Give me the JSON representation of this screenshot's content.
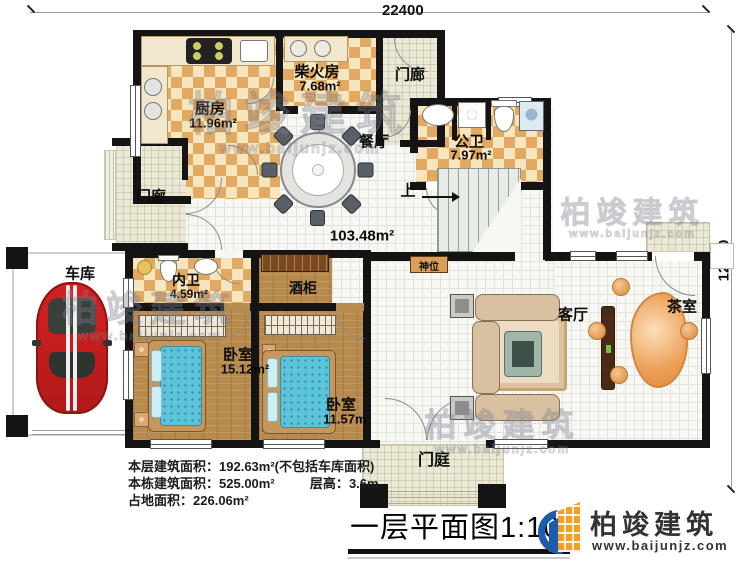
{
  "dimensions": {
    "top_width": "22400",
    "right_height": "12900"
  },
  "rooms": {
    "kitchen": {
      "name": "厨房",
      "area": "11.96m²"
    },
    "firewood_room": {
      "name": "柴火房",
      "area": "7.68m²"
    },
    "porch_top": {
      "name": "门廊"
    },
    "porch_left": {
      "name": "门廊"
    },
    "dining_room": {
      "name": "餐厅"
    },
    "public_bathroom": {
      "name": "公卫",
      "area": "7.97m²"
    },
    "hall": {
      "area": "103.48m²"
    },
    "stairs": {
      "up_label": "上"
    },
    "shrine": {
      "name": "神位"
    },
    "garage": {
      "name": "车库"
    },
    "private_bathroom": {
      "name": "内卫",
      "area": "4.59m²"
    },
    "wine_cabinet": {
      "name": "酒柜"
    },
    "bedroom_large": {
      "name": "卧室",
      "area": "15.12m²"
    },
    "bedroom_small": {
      "name": "卧室",
      "area": "11.57m²"
    },
    "living_room": {
      "name": "客厅"
    },
    "tea_room": {
      "name": "茶室"
    },
    "entrance_court": {
      "name": "门庭"
    }
  },
  "info": {
    "floor_area_label": "本层建筑面积：",
    "floor_area_value": "192.63m²(不包括车库面积)",
    "building_area_label": "本栋建筑面积：",
    "building_area_value": "525.00m²",
    "floor_height_label": "层高：",
    "floor_height_value": "3.6m",
    "land_area_label": "占地面积：",
    "land_area_value": "226.06m²"
  },
  "title": {
    "name": "一层平面图",
    "scale": "1:100"
  },
  "logo": {
    "company": "柏竣建筑",
    "website": "www.baijunjz.com"
  },
  "watermark": {
    "text": "柏竣建筑",
    "subtext": "www.baijunjz.com"
  },
  "colors": {
    "wall": "#141414",
    "checker_dark": "#e2a963",
    "checker_light": "#f7e5bd",
    "wood_floor": "#b78a4e",
    "car_red": "#c31f1f",
    "bed_blue": "#5cc4da",
    "logo_blue": "#1c5cab",
    "logo_orange": "#f59e1f"
  }
}
